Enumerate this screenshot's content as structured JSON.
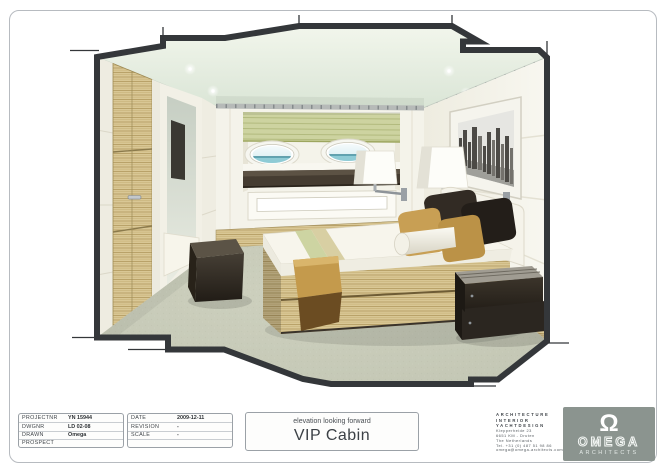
{
  "title_block": {
    "project": {
      "rows": [
        {
          "label": "PROJECTNR",
          "value": "YN 15944"
        },
        {
          "label": "DWGNR",
          "value": "LD 02-08"
        },
        {
          "label": "DRAWN",
          "value": "Omega"
        },
        {
          "label": "PROSPECT",
          "value": ""
        }
      ]
    },
    "meta": {
      "rows": [
        {
          "label": "DATE",
          "value": "2009-12-11"
        },
        {
          "label": "REVISION",
          "value": "-"
        },
        {
          "label": "SCALE",
          "value": "-"
        },
        {
          "label": "",
          "value": ""
        }
      ]
    },
    "title": {
      "subtitle": "elevation looking forward",
      "title": "VIP Cabin"
    },
    "firm": {
      "lines": [
        "ARCHITECTURE",
        "INTERIOR",
        "YACHTDESIGN",
        "Klepperheide 23",
        "6651 KM - Druten",
        "The Netherlands",
        "Tel. +31 (0) 487 51 98 86",
        "omega@omega-architects.com"
      ]
    },
    "logo": {
      "symbol": "Ω",
      "name": "OMEGA",
      "sub": "ARCHITECTS",
      "bg_color": "#8b948f"
    }
  },
  "drawing_palette": {
    "outline": "#34373a",
    "ceiling": "#e9efe2",
    "wall_cream": "#f4f3ea",
    "wood": "#d9c795",
    "blind_green": "#cdd3a0",
    "carpet": "#c9ccba",
    "dark_furniture": "#2b2620",
    "gold_throw": "#c49a4c"
  }
}
